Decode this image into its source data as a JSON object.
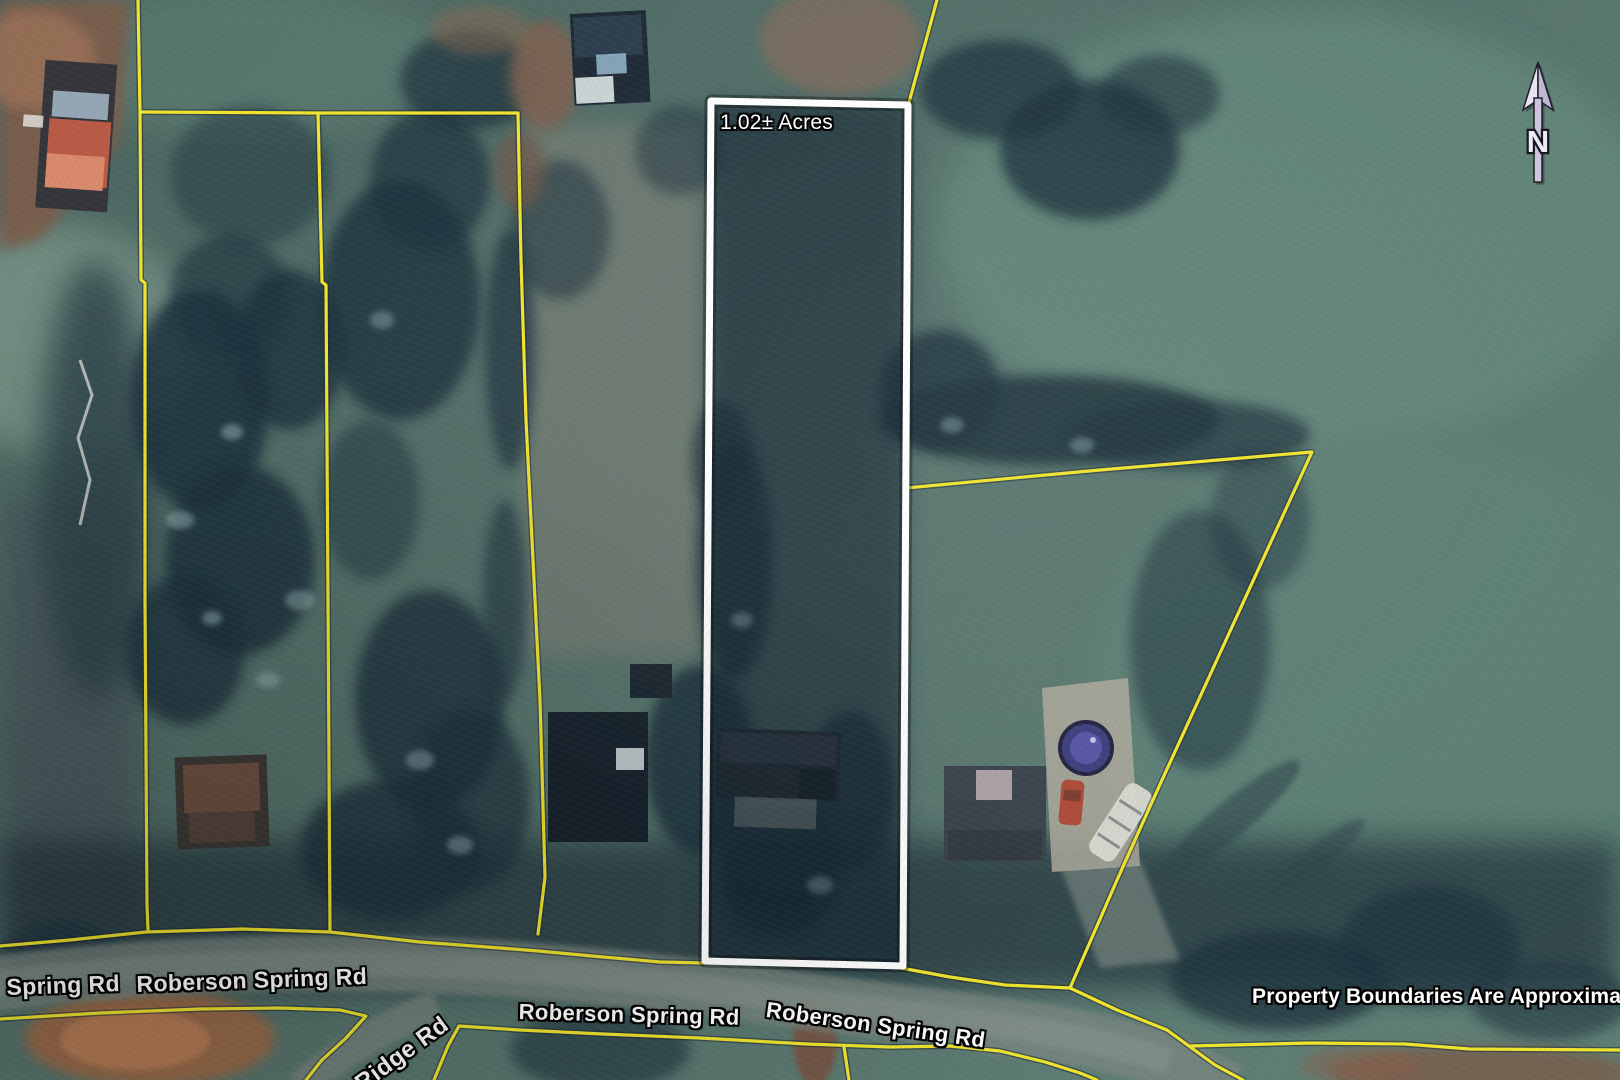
{
  "map": {
    "featured_parcel": {
      "acreage_label": "1.02± Acres"
    },
    "north_arrow": {
      "label": "N"
    },
    "road_labels": [
      "Spring Rd",
      "Roberson Spring Rd",
      "Roberson Spring Rd",
      "Roberson Spring Rd",
      "Ridge Rd"
    ],
    "disclaimer": "Property Boundaries Are Approximate",
    "colors": {
      "parcel_boundary_yellow": "#f0e42e",
      "featured_boundary_white": "#ffffff",
      "label_text": "#ffffff",
      "label_outline": "#000000",
      "north_arrow_fill": "#cfc5e2"
    }
  }
}
